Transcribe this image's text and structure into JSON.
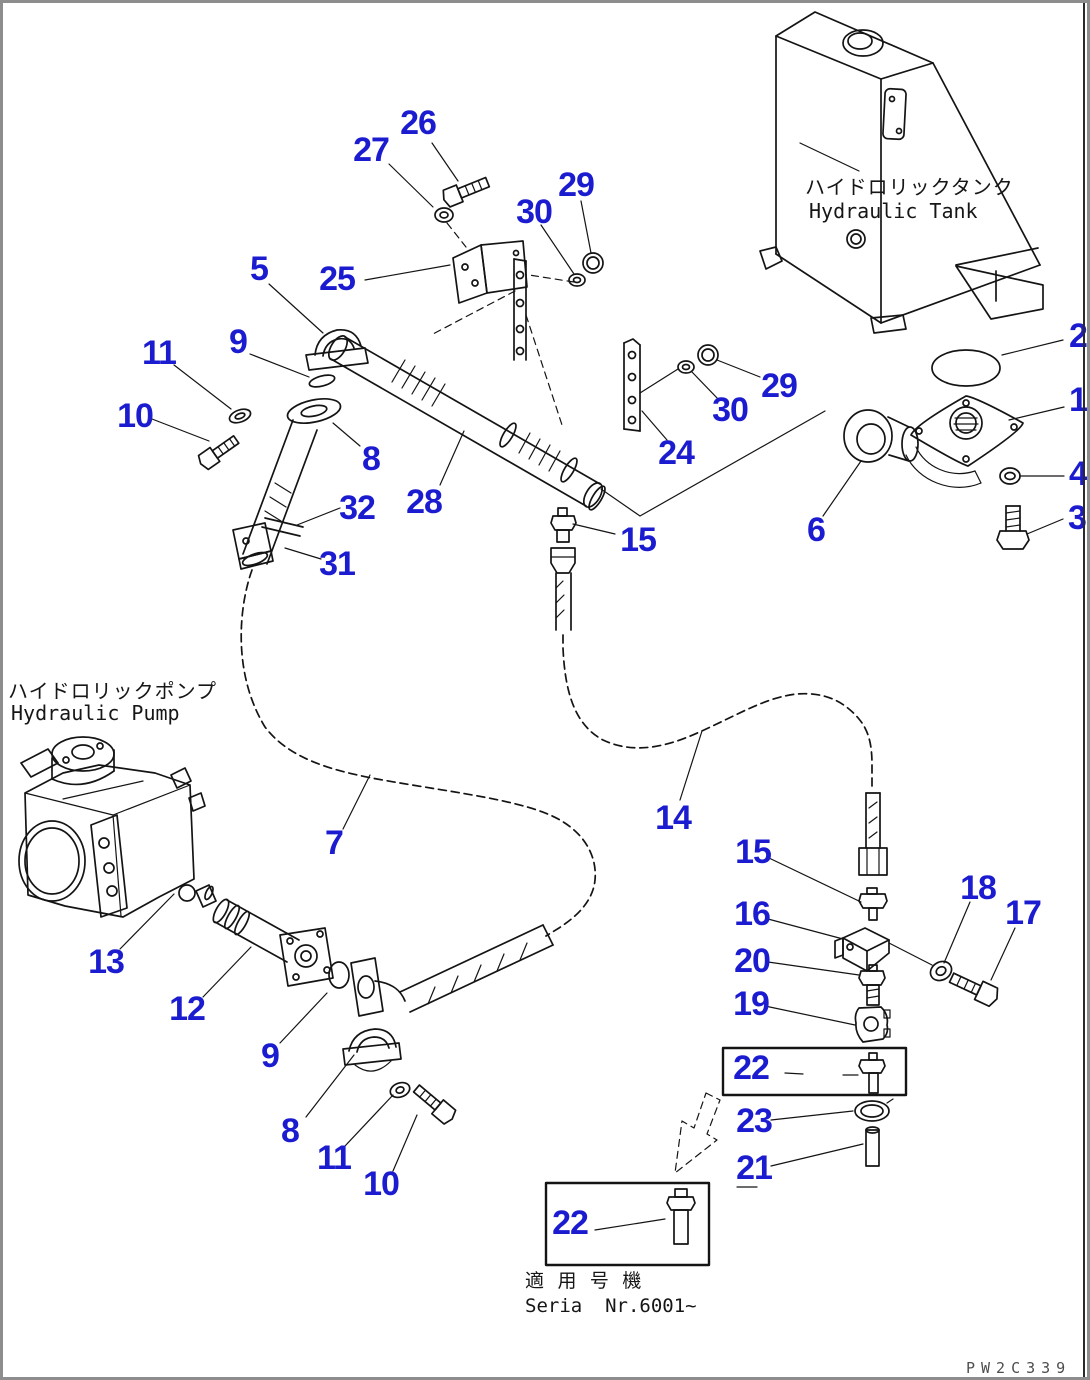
{
  "figure": {
    "tank": {
      "label_jp": "ハイドロリックタンク",
      "label_en": "Hydraulic Tank"
    },
    "pump": {
      "label_jp": "ハイドロリックポンプ",
      "label_en": "Hydraulic Pump"
    },
    "serial_note": {
      "line1_jp": "適 用 号 機",
      "line2": "Seria  Nr.6001~"
    },
    "watermark": "PW2C339",
    "colors": {
      "callout": "#1b1bd0",
      "line": "#141414",
      "frame": "#8d8d8d"
    }
  },
  "callouts": [
    {
      "label": "26",
      "x": 415,
      "y": 120
    },
    {
      "label": "27",
      "x": 368,
      "y": 147
    },
    {
      "label": "29",
      "x": 573,
      "y": 182
    },
    {
      "label": "30",
      "x": 531,
      "y": 209
    },
    {
      "label": "25",
      "x": 334,
      "y": 276
    },
    {
      "label": "5",
      "x": 256,
      "y": 266
    },
    {
      "label": "9",
      "x": 235,
      "y": 339
    },
    {
      "label": "11",
      "x": 156,
      "y": 350
    },
    {
      "label": "10",
      "x": 132,
      "y": 413
    },
    {
      "label": "8",
      "x": 368,
      "y": 456
    },
    {
      "label": "32",
      "x": 354,
      "y": 505
    },
    {
      "label": "31",
      "x": 334,
      "y": 561
    },
    {
      "label": "28",
      "x": 421,
      "y": 499
    },
    {
      "label": "24",
      "x": 673,
      "y": 450
    },
    {
      "label": "30",
      "x": 727,
      "y": 407
    },
    {
      "label": "29",
      "x": 776,
      "y": 383
    },
    {
      "label": "15",
      "x": 635,
      "y": 537
    },
    {
      "label": "2",
      "x": 1075,
      "y": 333
    },
    {
      "label": "1",
      "x": 1075,
      "y": 397
    },
    {
      "label": "4",
      "x": 1075,
      "y": 471
    },
    {
      "label": "3",
      "x": 1074,
      "y": 515
    },
    {
      "label": "6",
      "x": 813,
      "y": 527
    },
    {
      "label": "7",
      "x": 331,
      "y": 840
    },
    {
      "label": "14",
      "x": 670,
      "y": 815
    },
    {
      "label": "13",
      "x": 103,
      "y": 959
    },
    {
      "label": "12",
      "x": 184,
      "y": 1006
    },
    {
      "label": "9",
      "x": 267,
      "y": 1053
    },
    {
      "label": "8",
      "x": 287,
      "y": 1128
    },
    {
      "label": "11",
      "x": 331,
      "y": 1155
    },
    {
      "label": "10",
      "x": 378,
      "y": 1181
    },
    {
      "label": "15",
      "x": 750,
      "y": 849
    },
    {
      "label": "16",
      "x": 749,
      "y": 911
    },
    {
      "label": "18",
      "x": 975,
      "y": 885
    },
    {
      "label": "17",
      "x": 1020,
      "y": 910
    },
    {
      "label": "20",
      "x": 749,
      "y": 958
    },
    {
      "label": "19",
      "x": 748,
      "y": 1001
    },
    {
      "label": "22",
      "x": 748,
      "y": 1065
    },
    {
      "label": "23",
      "x": 751,
      "y": 1118
    },
    {
      "label": "21",
      "x": 751,
      "y": 1165
    },
    {
      "label": "22",
      "x": 567,
      "y": 1220
    }
  ]
}
